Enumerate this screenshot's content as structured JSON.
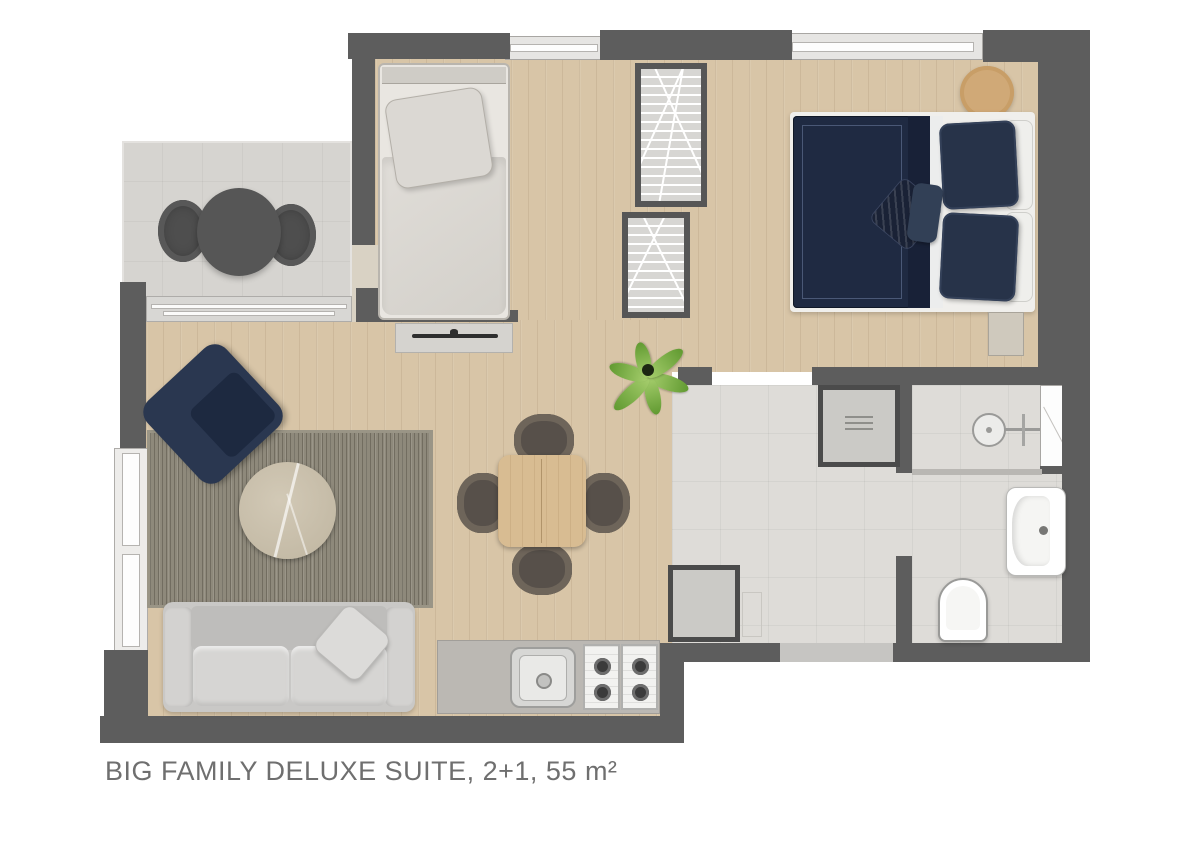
{
  "title": {
    "text": "BIG FAMILY DELUXE SUITE, 2+1, 55 m²"
  },
  "plan": {
    "type": "apartment-floor-plan",
    "rooms": [
      {
        "name": "balcony",
        "floor": "tile"
      },
      {
        "name": "single-bedroom",
        "floor": "wood"
      },
      {
        "name": "double-bedroom",
        "floor": "wood"
      },
      {
        "name": "living-room",
        "floor": "wood"
      },
      {
        "name": "kitchen",
        "floor": "wood"
      },
      {
        "name": "corridor",
        "floor": "tile"
      },
      {
        "name": "bathroom",
        "floor": "tile"
      }
    ],
    "furniture": [
      "balcony-round-table",
      "balcony-chair-left",
      "balcony-chair-right",
      "single-bed",
      "tv-unit",
      "wardrobe-upper",
      "wardrobe-lower",
      "double-bed",
      "bedside-stool",
      "nightstand",
      "armchair",
      "rug",
      "coffee-table",
      "sofa",
      "throw-pillow",
      "dining-table",
      "dining-chair-north",
      "dining-chair-south",
      "dining-chair-west",
      "dining-chair-east",
      "kitchen-counter",
      "kitchen-sink",
      "stove-4-burners",
      "storage-cabinet-top",
      "storage-cabinet-bottom",
      "plant",
      "shower-head",
      "bathroom-sink",
      "toilet",
      "entrance-threshold"
    ],
    "colors": {
      "wall": "#5d5d5d",
      "wood_floor": "#d8c5a7",
      "tile_floor": "#dedcd8",
      "balcony_tile": "#d6d4d0",
      "navy_bedding": "#1f2a42",
      "rug": "#8e897b",
      "sofa": "#c9c8c6",
      "counter": "#bbb8b3",
      "table_wood": "#d8bc92",
      "plant_green": "#619a31",
      "title_text": "#6f6f6f"
    }
  }
}
